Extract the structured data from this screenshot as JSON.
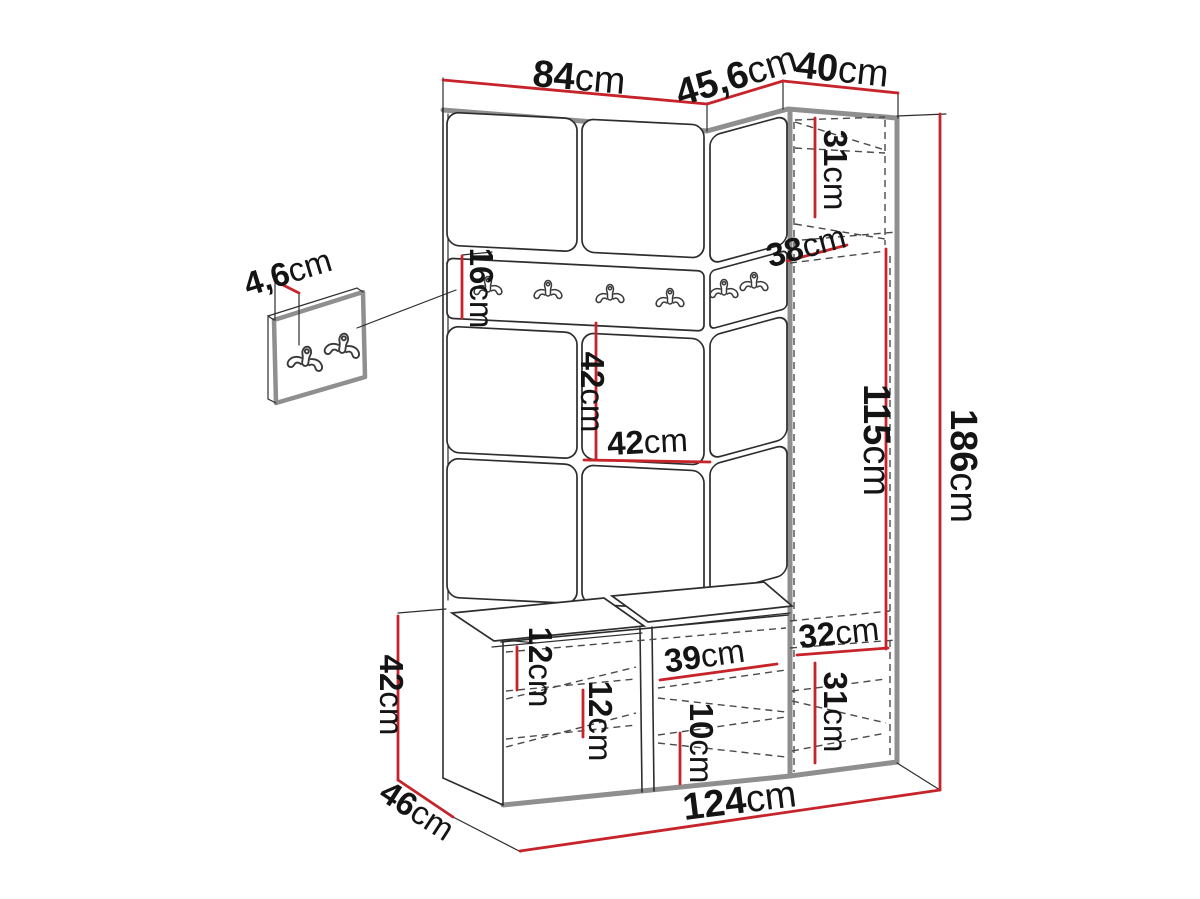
{
  "diagram": {
    "type": "furniture-dimension-drawing",
    "subject": "hallway wardrobe set with coat hook rail, corner cabinet and shoe bench",
    "units": "cm",
    "colors": {
      "dimension_red": "#c6242a",
      "outline_black": "#2d2d2d",
      "edge_gray": "#8f8f8f",
      "background": "#ffffff"
    },
    "icons": {
      "coat_hook": "double-prong-wall-hook"
    },
    "dimensions": {
      "top_front_width": "84cm",
      "top_angled_width": "45,6cm",
      "top_side_width": "40cm",
      "upper_cabinet_height": "31cm",
      "corner_depth": "38cm",
      "hook_panel_width": "4,6cm",
      "rail_panel_height": "16cm",
      "wall_panel_height": "42cm",
      "wall_panel_width": "42cm",
      "open_niche_height": "115cm",
      "total_height": "186cm",
      "niche_width": "32cm",
      "lower_side_cabinet_height": "31cm",
      "bench_shelf_width": "39cm",
      "bench_top_offset": "12cm",
      "bench_shelf_spacing": "12cm",
      "bench_shoe_space_height": "10cm",
      "total_width": "124cm",
      "bench_depth": "46cm",
      "bench_height": "42cm"
    }
  }
}
